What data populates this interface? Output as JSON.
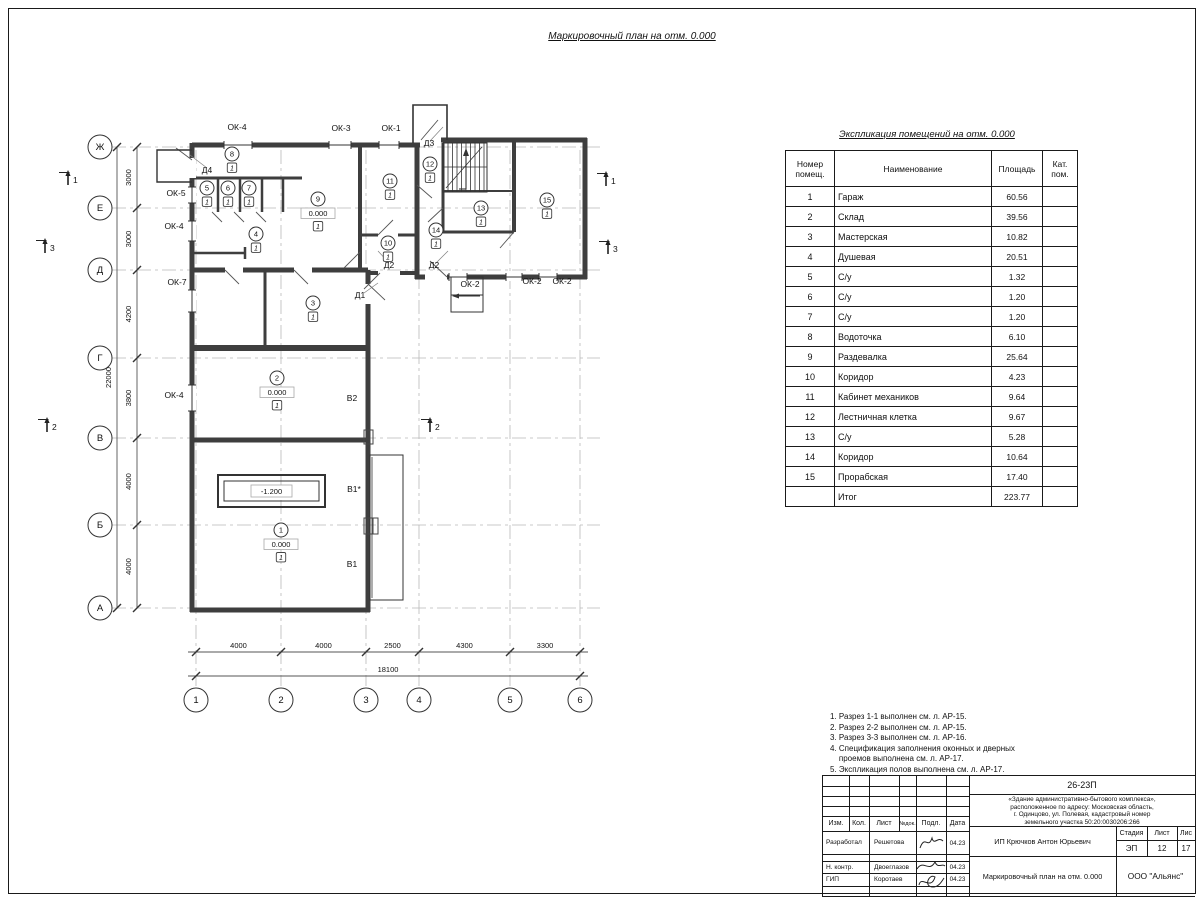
{
  "sheet": {
    "plan_title": "Маркировочный план на отм. 0.000",
    "table_title": "Экспликация помещений на отм. 0.000"
  },
  "plan": {
    "grid_letters": [
      "Ж",
      "Е",
      "Д",
      "Г",
      "В",
      "Б",
      "А"
    ],
    "grid_numbers": [
      "1",
      "2",
      "3",
      "4",
      "5",
      "6"
    ],
    "dims_left": [
      "3000",
      "3000",
      "4200",
      "3800",
      "4000",
      "4000"
    ],
    "dims_left_total": "22000",
    "dims_bottom": [
      "4000",
      "4000",
      "2500",
      "4300",
      "3300"
    ],
    "dims_bottom_total": "18100",
    "pit_label": "-1.200",
    "openings": [
      {
        "label": "ОК-4",
        "x": 237,
        "y": 130
      },
      {
        "label": "ОК-3",
        "x": 341,
        "y": 131
      },
      {
        "label": "ОК-1",
        "x": 391,
        "y": 131
      },
      {
        "label": "Д3",
        "x": 429,
        "y": 146
      },
      {
        "label": "Д4",
        "x": 207,
        "y": 173
      },
      {
        "label": "ОК-5",
        "x": 176,
        "y": 196
      },
      {
        "label": "ОК-4",
        "x": 174,
        "y": 229
      },
      {
        "label": "ОК-7",
        "x": 177,
        "y": 285
      },
      {
        "label": "ОК-4",
        "x": 174,
        "y": 398
      },
      {
        "label": "Д2",
        "x": 389,
        "y": 268
      },
      {
        "label": "Д2",
        "x": 434,
        "y": 268
      },
      {
        "label": "Д1",
        "x": 360,
        "y": 298
      },
      {
        "label": "ОК-2",
        "x": 470,
        "y": 287
      },
      {
        "label": "ОК-2",
        "x": 532,
        "y": 284
      },
      {
        "label": "ОК-2",
        "x": 562,
        "y": 284
      },
      {
        "label": "В2",
        "x": 352,
        "y": 401
      },
      {
        "label": "В1*",
        "x": 354,
        "y": 492
      },
      {
        "label": "В1",
        "x": 352,
        "y": 567
      }
    ],
    "rooms": [
      {
        "num": "8",
        "x": 232,
        "y": 154,
        "cat": "1"
      },
      {
        "num": "5",
        "x": 207,
        "y": 188,
        "cat": "1"
      },
      {
        "num": "6",
        "x": 228,
        "y": 188,
        "cat": "1"
      },
      {
        "num": "7",
        "x": 249,
        "y": 188,
        "cat": "1"
      },
      {
        "num": "9",
        "x": 318,
        "y": 199,
        "elev": "0.000",
        "cat": "1"
      },
      {
        "num": "4",
        "x": 256,
        "y": 234,
        "cat": "1"
      },
      {
        "num": "11",
        "x": 390,
        "y": 181,
        "cat": "1"
      },
      {
        "num": "12",
        "x": 430,
        "y": 164,
        "cat": "1"
      },
      {
        "num": "10",
        "x": 388,
        "y": 243,
        "cat": "1"
      },
      {
        "num": "13",
        "x": 481,
        "y": 208,
        "cat": "1"
      },
      {
        "num": "14",
        "x": 436,
        "y": 230,
        "cat": "1"
      },
      {
        "num": "15",
        "x": 547,
        "y": 200,
        "cat": "1"
      },
      {
        "num": "3",
        "x": 313,
        "y": 303,
        "cat": "1"
      },
      {
        "num": "2",
        "x": 277,
        "y": 378,
        "elev": "0.000",
        "cat": "1"
      },
      {
        "num": "1",
        "x": 281,
        "y": 530,
        "elev": "0.000",
        "cat": "1"
      }
    ],
    "sections": [
      {
        "num": "1",
        "x": 68,
        "y": 185
      },
      {
        "num": "3",
        "x": 45,
        "y": 253
      },
      {
        "num": "2",
        "x": 47,
        "y": 432
      },
      {
        "num": "1",
        "x": 606,
        "y": 186
      },
      {
        "num": "3",
        "x": 608,
        "y": 254
      },
      {
        "num": "2",
        "x": 430,
        "y": 432
      }
    ]
  },
  "table": {
    "headers": [
      "Номер\nпомещ.",
      "Наименование",
      "Площадь",
      "Кат.\nпом."
    ],
    "rows": [
      [
        "1",
        "Гараж",
        "60.56"
      ],
      [
        "2",
        "Склад",
        "39.56"
      ],
      [
        "3",
        "Мастерская",
        "10.82"
      ],
      [
        "4",
        "Душевая",
        "20.51"
      ],
      [
        "5",
        "С/у",
        "1.32"
      ],
      [
        "6",
        "С/у",
        "1.20"
      ],
      [
        "7",
        "С/у",
        "1.20"
      ],
      [
        "8",
        "Водоточка",
        "6.10"
      ],
      [
        "9",
        "Раздевалка",
        "25.64"
      ],
      [
        "10",
        "Коридор",
        "4.23"
      ],
      [
        "11",
        "Кабинет механиков",
        "9.64"
      ],
      [
        "12",
        "Лестничная клетка",
        "9.67"
      ],
      [
        "13",
        "С/у",
        "5.28"
      ],
      [
        "14",
        "Коридор",
        "10.64"
      ],
      [
        "15",
        "Прорабская",
        "17.40"
      ]
    ],
    "total_label": "Итог",
    "total_value": "223.77"
  },
  "notes": [
    "1. Разрез 1-1 выполнен см. л. АР-15.",
    "2. Разрез 2-2 выполнен см. л. АР-15.",
    "3. Разрез 3-3 выполнен см. л. АР-16.",
    "4. Спецификация заполнения оконных и дверных",
    "    проемов выполнена см. л. АР-17.",
    "5. Экспликация полов выполнена см. л. АР-17."
  ],
  "titleblock": {
    "code": "26-23П",
    "description_lines": [
      "«Здание административно-бытового комплекса»,",
      "расположенное по адресу: Московская область,",
      "г. Одинцово, ул. Полевая, кадастровый номер",
      "земельного участка 50:20:0030206:266"
    ],
    "columns": [
      "Изм.",
      "Кол.",
      "Лист",
      "№док.",
      "Подл.",
      "Дата"
    ],
    "signers": [
      {
        "role": "Разработал",
        "name": "Решетова",
        "date": "04.23"
      },
      {
        "role": "Н. контр.",
        "name": "Двоеглазов",
        "date": "04.23"
      },
      {
        "role": "ГИП",
        "name": "Коротаев",
        "date": "04.23"
      }
    ],
    "client": "ИП Крючков Антон Юрьевич",
    "stage_label": "Стадия",
    "sheet_label": "Лист",
    "sheets_label": "Лис",
    "stage": "ЭП",
    "sheet": "12",
    "sheets": "17",
    "doc_title": "Маркировочный план на отм. 0.000",
    "company": "ООО \"Альянс\""
  }
}
